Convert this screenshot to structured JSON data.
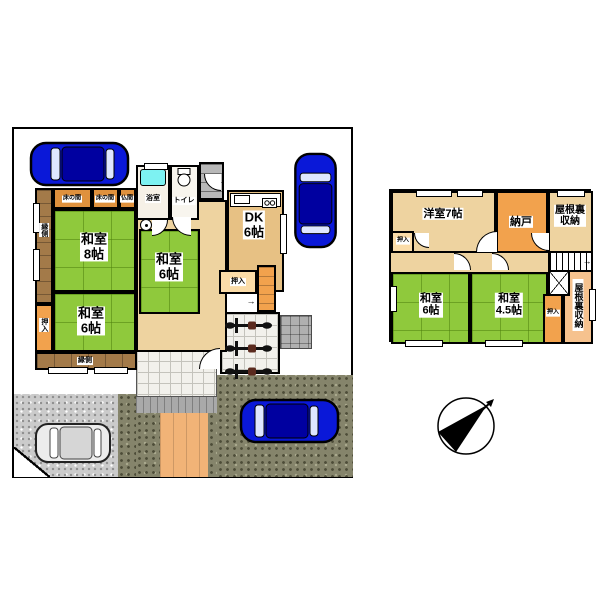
{
  "floor1": {
    "engawa_left": "縁側",
    "oshiire_left": "押入",
    "tokonoma_a": "床の間",
    "tokonoma_b": "床の間",
    "butsuma": "仏間",
    "bath": "浴室",
    "toilet": "トイレ",
    "washitsu8_name": "和室",
    "washitsu8_size": "8帖",
    "washitsu6c_name": "和室",
    "washitsu6c_size": "6帖",
    "washitsu6b_name": "和室",
    "washitsu6b_size": "6帖",
    "dk_name": "DK",
    "dk_size": "6帖",
    "oshiire_dk": "押入",
    "engawa_bottom": "縁側",
    "stairs_arrow": "→"
  },
  "floor2": {
    "yoshitsu7": "洋室7帖",
    "nando": "納戸",
    "yaneura_top_l1": "屋根裏",
    "yaneura_top_l2": "収納",
    "oshiire_a": "押入",
    "washitsu6_name": "和室",
    "washitsu6_size": "6帖",
    "washitsu45_name": "和室",
    "washitsu45_size": "4.5帖",
    "oshiire_b": "押入",
    "yaneura_right": "屋根裏収納",
    "stairs_arrow": "→"
  },
  "colors": {
    "tatami_green": "#8fc93c",
    "floor_beige": "#eed3a0",
    "closet_orange": "#f2a24d",
    "engawa_brown": "#a37a49",
    "bathtub_cyan": "#7df2f2",
    "car_blue": "#0a18d8",
    "wall_black": "#000000"
  }
}
